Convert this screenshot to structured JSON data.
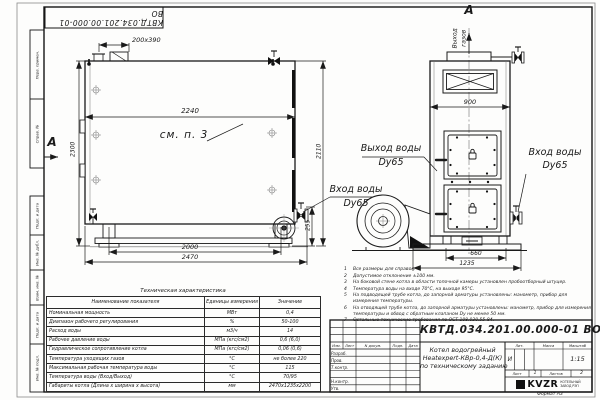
{
  "frame": {
    "top_stamp": "КВТД.034.201.00.000-01 ВО",
    "format_note": "Формат А3",
    "margin_top": [
      {
        "label": "Перв. примен."
      },
      {
        "label": "Справ. №"
      }
    ],
    "margin_bottom": [
      {
        "label": "Подп. и дата"
      },
      {
        "label": "Инв. № дубл."
      },
      {
        "label": "Взам. инв. №"
      },
      {
        "label": "Подп. и дата"
      },
      {
        "label": "Инв. № подл."
      }
    ]
  },
  "side_view": {
    "section_letter": "А",
    "ref_note": "см. п. 3",
    "dim_hatch": "200х390",
    "dim_width": "2240",
    "dim_height": "2300",
    "dim_bottom_inner": "2000",
    "dim_bottom_outer": "2470",
    "dim_outlet_height": "255",
    "dim_total_height": "2110",
    "inlet_label": "Вход воды",
    "inlet_dn": "Dy65"
  },
  "front_view": {
    "section_letter": "А",
    "flue_word1": "Выход",
    "flue_word2": "газов",
    "dim_width": "900",
    "dim_base_inner": "660",
    "dim_base_outer": "1235",
    "outlet_label": "Выход воды",
    "outlet_dn": "Dy65",
    "inlet_label": "Вход воды",
    "inlet_dn": "Dy65"
  },
  "notes": {
    "items": [
      {
        "n": "1",
        "text": "Все размеры для справок."
      },
      {
        "n": "2",
        "text": "Допустимое отклонение ±100 мм."
      },
      {
        "n": "3",
        "text": "На боковой стене котла в области топочной камеры установлен пробоотборный штуцер."
      },
      {
        "n": "4",
        "text": "Температура воды на входе 70°С, на выходе 95°С."
      },
      {
        "n": "5",
        "text": "На подводящей трубе котла, до запорной арматуры установлены: манометр, прибор для измерения температуры."
      },
      {
        "n": "6",
        "text": "На отводящей трубе котла, до запорной арматуры установлены: манометр, прибор для измерения температуры и обвод с обратным клапаном Dу не менее 50 мм."
      },
      {
        "n": "7",
        "text": "Остальные технические требования по ОСТ 108.030.55-84."
      }
    ]
  },
  "spec_table": {
    "title": "Техническая характеристика",
    "headers": [
      "Наименование показателя",
      "Единицы измерения",
      "Значение"
    ],
    "rows": [
      [
        "Номинальная мощность",
        "МВт",
        "0,4"
      ],
      [
        "Диапазон рабочего регулирования",
        "%",
        "50-100"
      ],
      [
        "Расход воды",
        "м3/ч",
        "14"
      ],
      [
        "Рабочее давление воды",
        "МПа (кгс/см2)",
        "0,6 (6,0)"
      ],
      [
        "Гидравлическое сопротивление котла",
        "МПа (кгс/см2)",
        "0,06 (0,6)"
      ],
      [
        "Температура уходящих газов",
        "°С",
        "не более 220"
      ],
      [
        "Максимальная рабочая температура воды",
        "°С",
        "115"
      ],
      [
        "Температура воды (Вход/Выход)",
        "°С",
        "70/95"
      ],
      [
        "Габариты котла (Длина х ширина х высота)",
        "мм",
        "2470х1235х2200"
      ]
    ]
  },
  "title_block": {
    "doc_number": "КВТД.034.201.00.000-01 ВО",
    "product_name_1": "Котел водогрейный",
    "product_name_2": "Heatexpert-КВр-0,4-Д(К)",
    "product_name_3": "по техническому заданию",
    "header_cols": [
      "Изм.",
      "Лист",
      "N докум.",
      "Подп.",
      "Дата"
    ],
    "roles": [
      "Разраб.",
      "Пров.",
      "Т.контр.",
      "Н.контр.",
      "Утв."
    ],
    "lit_label": "Лит.",
    "mass_label": "Масса",
    "scale_label": "Масштаб",
    "lit_value": "И",
    "scale_value": "1:15",
    "sheet_label": "Лист",
    "sheet_value": "1",
    "sheets_label": "Листов",
    "sheets_value": "2",
    "logo_text": "KVZR",
    "logo_sub_1": "КОТЕЛЬНЫЙ",
    "logo_sub_2": "ЗАВОД РЭП"
  }
}
